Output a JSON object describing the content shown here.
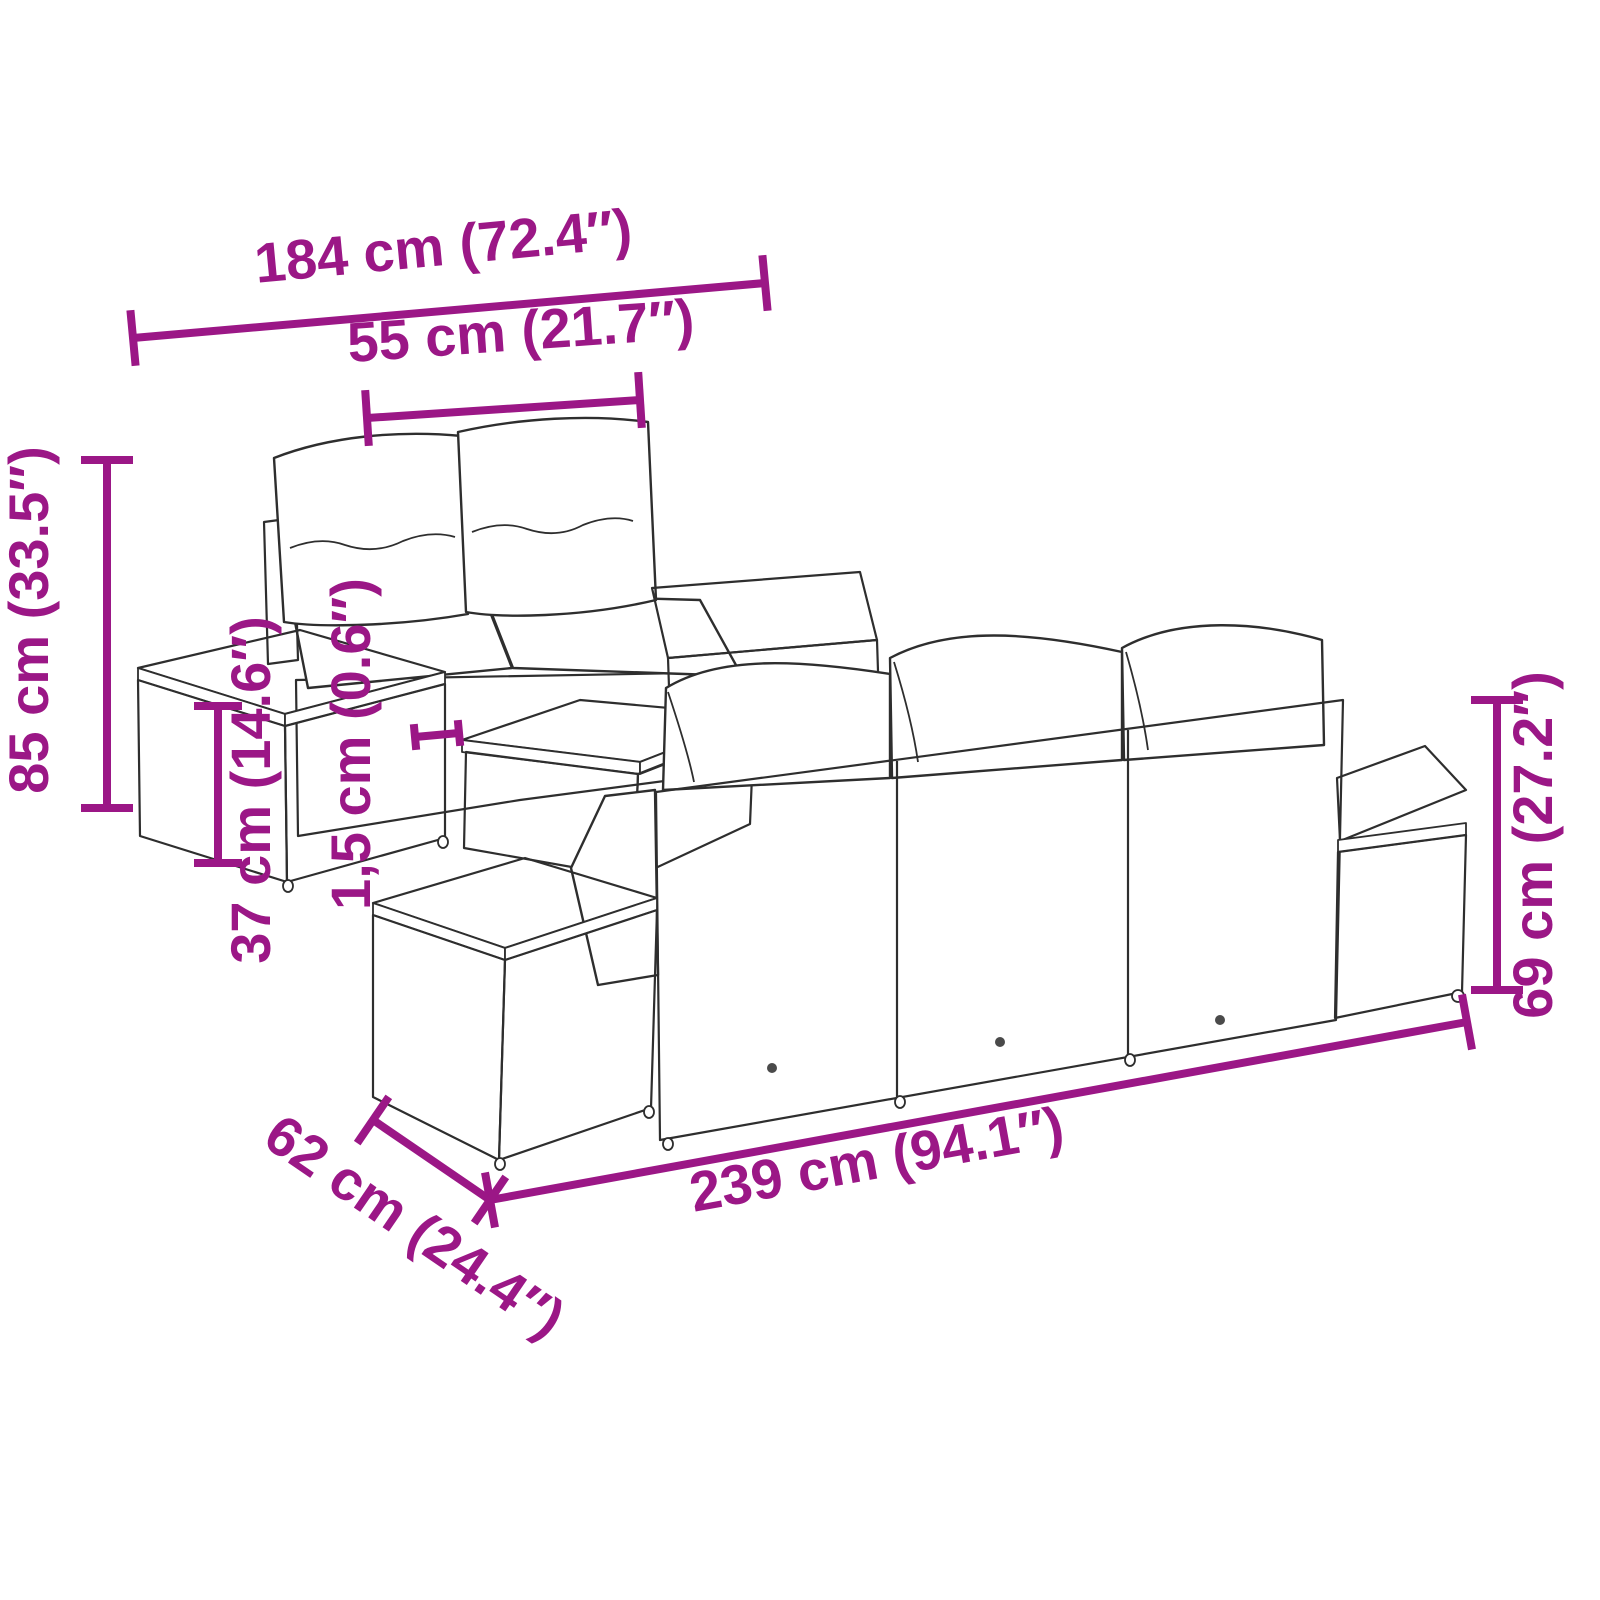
{
  "diagram": {
    "accent_color": "#9B1786",
    "line_color": "#2e2e2e",
    "product": "garden-sofa-set-dimension-diagram",
    "dimensions": {
      "total_width": "184 cm (72.4″)",
      "seat_width": "55 cm (21.7″)",
      "total_height": "85 cm (33.5″)",
      "side_table_height": "37 cm (14.6″)",
      "slat_thickness": "1,5 cm (0.6″)",
      "back_height": "69 cm (27.2″)",
      "total_length": "239 cm (94.1″)",
      "depth": "62 cm (24.4″)"
    }
  }
}
